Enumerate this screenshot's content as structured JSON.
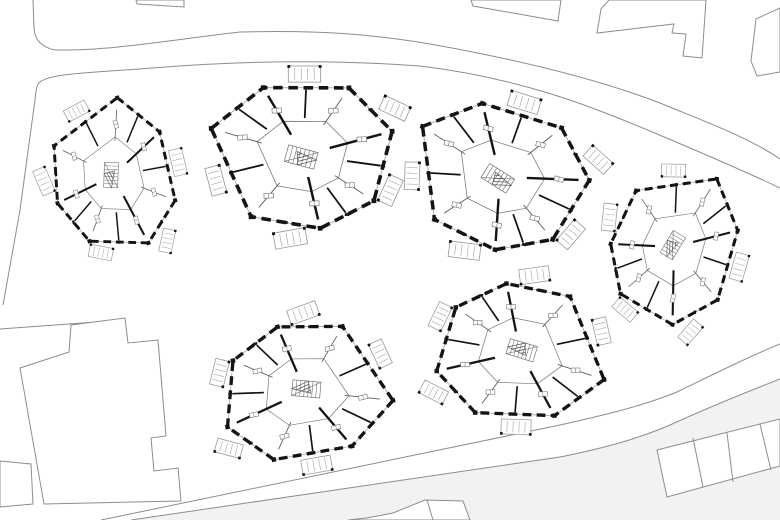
{
  "canvas": {
    "width": 780,
    "height": 520,
    "background": "#ffffff"
  },
  "colors": {
    "site_line": "#8d8d8d",
    "wall": "#141414",
    "interior_line": "#5f5f5f",
    "thin_line": "#9a9a9a",
    "fixture_line": "#777777",
    "offsite_fill": "#f2f2f2",
    "paper": "#ffffff"
  },
  "offsite_region": "M 131,520 L 560,457 C 600,449 635,440 670,425 C 716,404 752,390 780,379 L 780,520 Z",
  "roads": {
    "paths": [
      "M 33,0 L 34,28 Q 35,46 55,50 C 110,51 170,40 240,32 C 320,30 370,34 430,44 C 520,60 600,80 660,103 C 706,122 748,137 780,159",
      "M 780,188 C 742,170 700,152 650,131 C 590,106 520,78 420,66 C 340,60 250,60 152,68 C 90,73 45,73 38,84 Q 36,88 35,100 L 20,210 L 3,305",
      "M 780,344 C 755,354 722,370 677,392 C 640,407 600,416 560,425 L 101,520",
      "M 780,379 C 752,390 716,404 670,425 C 635,440 600,449 560,457 L 131,520"
    ],
    "boundary_lines": [
      "M 0,329 L 124,320"
    ]
  },
  "neighbors": [
    {
      "id": "north-west-sliver",
      "path": "M 136,0 L 184,0 L 184,7 L 137,4 Z"
    },
    {
      "id": "north-slab",
      "path": "M 471,0 L 561,0 L 558,21 L 473,6 Z"
    },
    {
      "id": "north-stepped-slab",
      "path": "M 609,0 L 601,9 L 597,33 L 674,24 L 672,33 L 686,34 L 683,56 L 702,58 L 706,0 Z"
    },
    {
      "id": "north-east-corner",
      "path": "M 780,8 L 756,19 L 751,61 L 757,76 L 780,72 Z"
    },
    {
      "id": "south-west-block",
      "path": "M 20,368 L 69,352 L 71,325 L 125,318 L 128,343 L 158,340 L 166,436 L 151,438 L 154,471 L 178,468 L 181,501 L 44,504 Z"
    },
    {
      "id": "south-west-annex",
      "path": "M 0,461 L 31,464 L 33,504 L 0,507 Z"
    },
    {
      "id": "south-east-row",
      "path": "M 657,450 L 780,419 L 780,466 L 667,497 Z"
    },
    {
      "id": "south-row",
      "path": "M 348,520 L 367,518 L 393,513 L 425,500 L 463,501 L 470,520 Z"
    }
  ],
  "neighbor_dividers": [
    "M 693,438 L 703,487",
    "M 727,433 L 733,482",
    "M 760,424 L 771,470",
    "M 427,500 L 433,520"
  ],
  "apartment_template": {
    "outline": [
      [
        -95,
        -33
      ],
      [
        -38,
        -73
      ],
      [
        52,
        -68
      ],
      [
        95,
        -20
      ],
      [
        72,
        52
      ],
      [
        14,
        78
      ],
      [
        -58,
        62
      ]
    ],
    "wall_width": 3.8,
    "wall_dash": "10 6",
    "corner_block": 5,
    "spokes_thick": [
      1,
      3,
      5
    ],
    "spokes_thin": [
      0,
      2,
      4,
      6
    ],
    "mid_wall_edges": [
      0,
      1,
      3,
      4,
      6
    ],
    "inner_ring_scale": 0.5,
    "fixture_scale": 0.66,
    "fixture_size": [
      10,
      5
    ],
    "stair": {
      "x": -2,
      "y": 2,
      "w": 32,
      "h": 18,
      "rot": 18,
      "rungs": 7
    },
    "hatch_wedge": [
      [
        -6,
        -4
      ],
      [
        14,
        6
      ],
      [
        -6,
        10
      ]
    ],
    "balconies": [
      {
        "x": 6,
        "y": -85,
        "rot": 3,
        "w": 34,
        "h": 17
      },
      {
        "x": 99,
        "y": -44,
        "rot": 28,
        "w": 30,
        "h": 16
      },
      {
        "x": 90,
        "y": 42,
        "rot": -63,
        "w": 30,
        "h": 16
      },
      {
        "x": -18,
        "y": 87,
        "rot": -7,
        "w": 34,
        "h": 17
      },
      {
        "x": -93,
        "y": 22,
        "rot": 78,
        "w": 30,
        "h": 16
      }
    ]
  },
  "buildings": [
    {
      "id": 1,
      "cx": 113,
      "cy": 176,
      "rot": 74,
      "scale": 0.78
    },
    {
      "id": 2,
      "cx": 303,
      "cy": 155,
      "rot": -3,
      "scale": 0.95
    },
    {
      "id": 3,
      "cx": 500,
      "cy": 177,
      "rot": 14,
      "scale": 0.92
    },
    {
      "id": 4,
      "cx": 674,
      "cy": 247,
      "rot": 103,
      "scale": 0.8
    },
    {
      "id": 5,
      "cx": 305,
      "cy": 391,
      "rot": 167,
      "scale": 0.88
    },
    {
      "id": 6,
      "cx": 520,
      "cy": 352,
      "rot": 179,
      "scale": 0.88
    }
  ]
}
